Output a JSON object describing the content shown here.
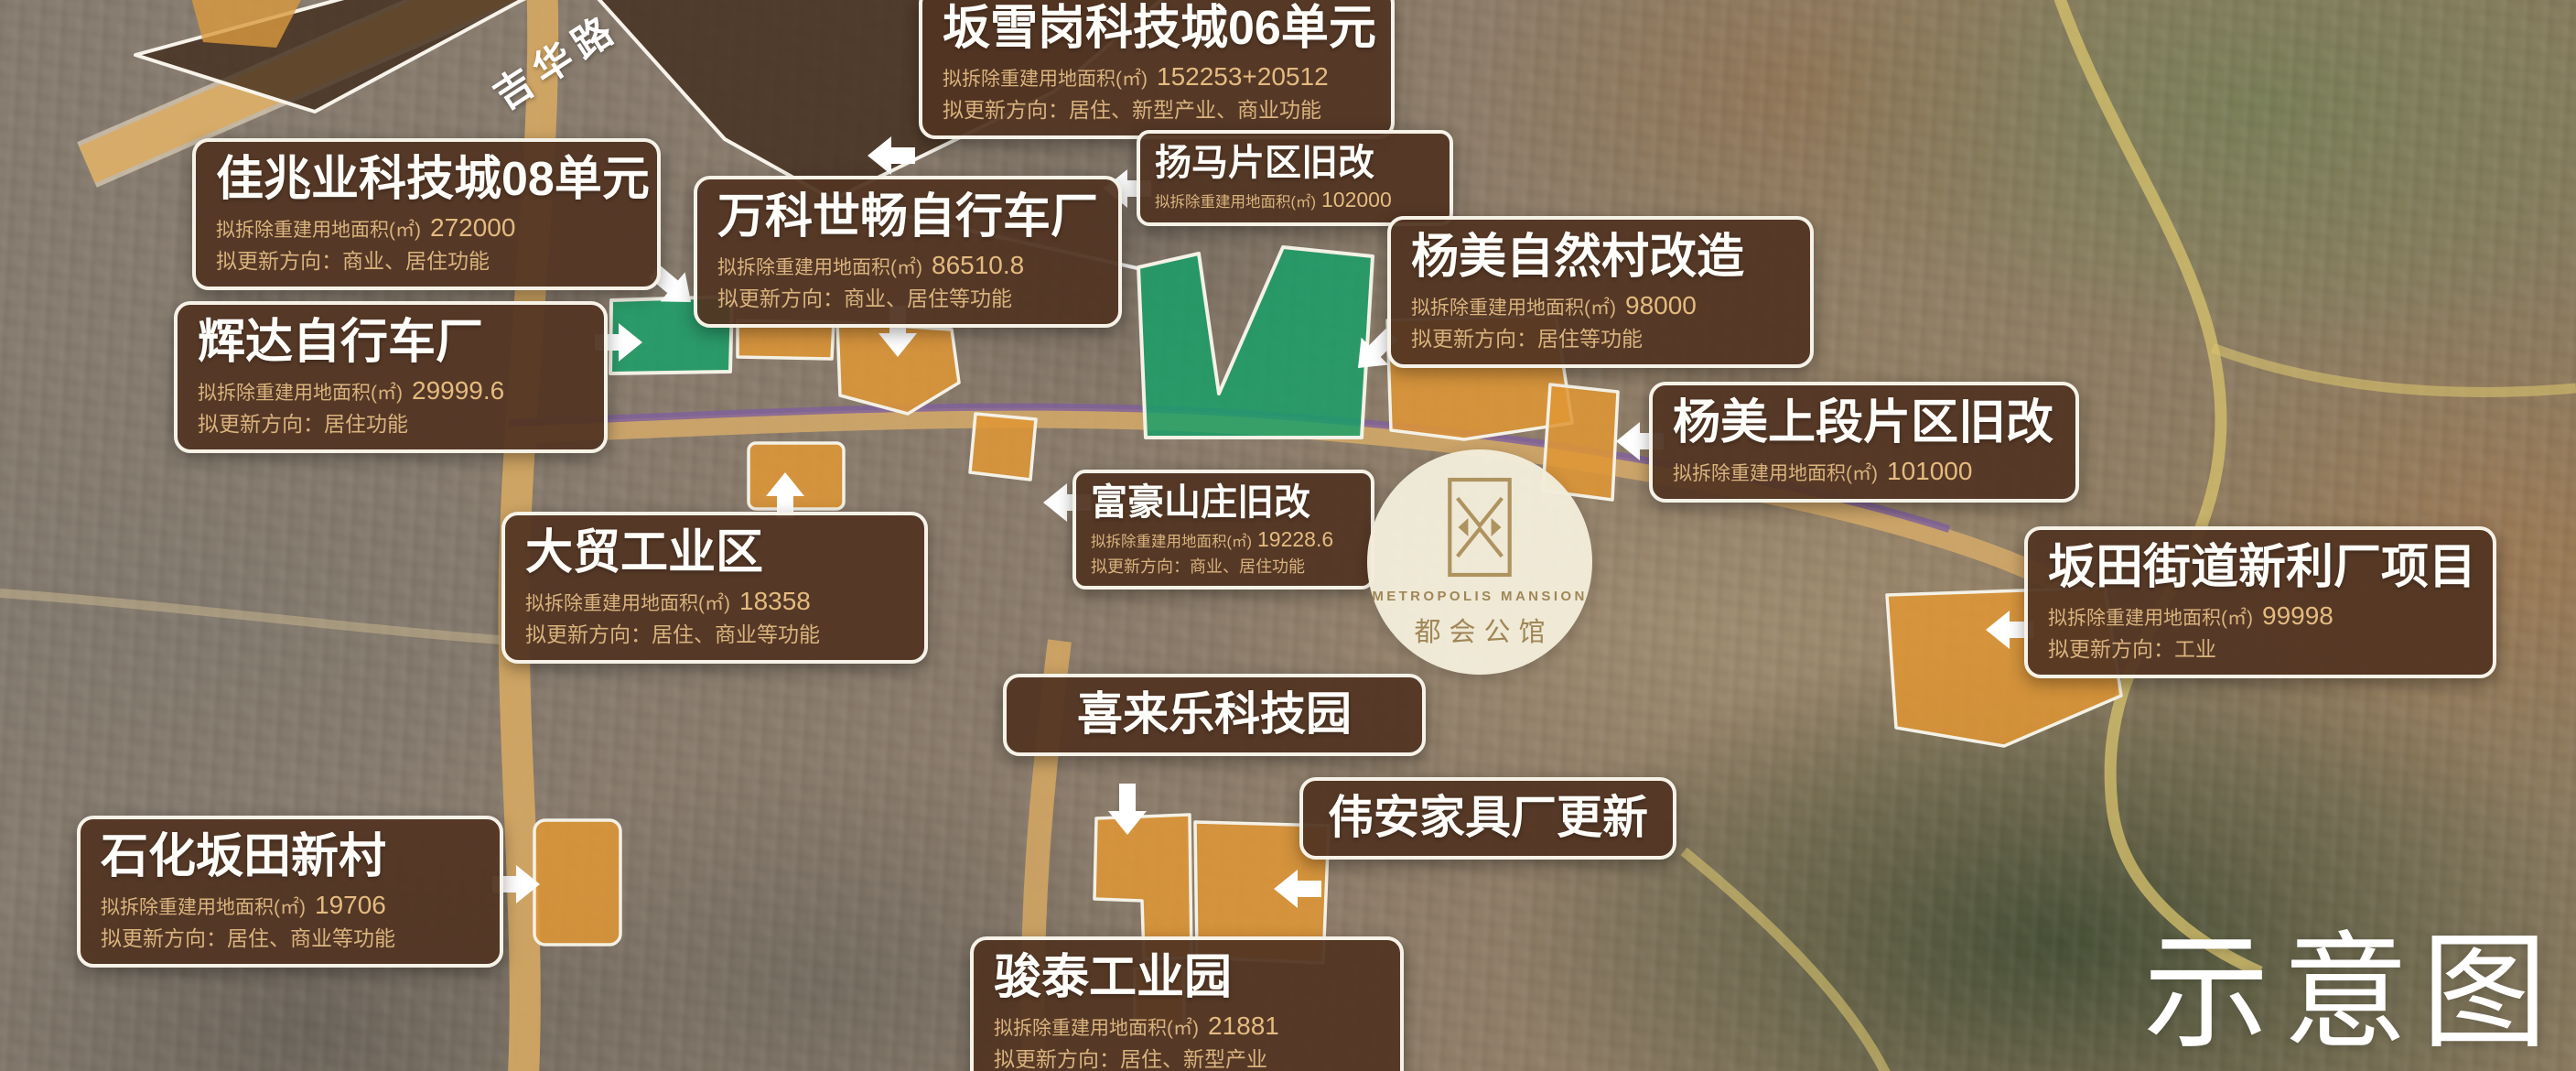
{
  "map": {
    "road_label": "吉华路",
    "watermark": "示意图",
    "logo": {
      "name_en": "METROPOLIS MANSION",
      "name_cn": "都会公馆"
    },
    "colors": {
      "callout_bg": "#54361f",
      "callout_border": "#f6f2e8",
      "callout_title": "#ffffff",
      "callout_detail": "#d9b37e",
      "zone_orange": "#e09634",
      "zone_green": "#16a068",
      "zone_dark_brown": "#402a1a",
      "road_tan": "#d8ab66",
      "metro_purple": "#7e5f9e",
      "logo_gold": "#a18757"
    }
  },
  "callouts": {
    "banxuegang": {
      "title": "坂雪岗科技城06单元",
      "area_label": "拟拆除重建用地面积(㎡)",
      "area_value": "152253+20512",
      "direction": "拟更新方向：居住、新型产业、商业功能"
    },
    "jiazhaoye": {
      "title": "佳兆业科技城08单元",
      "area_label": "拟拆除重建用地面积(㎡)",
      "area_value": "272000",
      "direction": "拟更新方向：商业、居住功能"
    },
    "wanke": {
      "title": "万科世畅自行车厂",
      "area_label": "拟拆除重建用地面积(㎡)",
      "area_value": "86510.8",
      "direction": "拟更新方向：商业、居住等功能"
    },
    "yangma": {
      "title": "扬马片区旧改",
      "area_label": "拟拆除重建用地面积(㎡)",
      "area_value": "102000"
    },
    "yangmei_village": {
      "title": "杨美自然村改造",
      "area_label": "拟拆除重建用地面积(㎡)",
      "area_value": "98000",
      "direction": "拟更新方向：居住等功能"
    },
    "huida": {
      "title": "辉达自行车厂",
      "area_label": "拟拆除重建用地面积(㎡)",
      "area_value": "29999.6",
      "direction": "拟更新方向：居住功能"
    },
    "yangmei_upper": {
      "title": "杨美上段片区旧改",
      "area_label": "拟拆除重建用地面积(㎡)",
      "area_value": "101000"
    },
    "fuhao": {
      "title": "富豪山庄旧改",
      "area_label": "拟拆除重建用地面积(㎡)",
      "area_value": "19228.6",
      "direction": "拟更新方向：商业、居住功能"
    },
    "damao": {
      "title": "大贸工业区",
      "area_label": "拟拆除重建用地面积(㎡)",
      "area_value": "18358",
      "direction": "拟更新方向：居住、商业等功能"
    },
    "xinli": {
      "title": "坂田街道新利厂项目",
      "area_label": "拟拆除重建用地面积(㎡)",
      "area_value": "99998",
      "direction": "拟更新方向：工业"
    },
    "xilaile": {
      "title": "喜来乐科技园"
    },
    "weian": {
      "title": "伟安家具厂更新"
    },
    "shihua": {
      "title": "石化坂田新村",
      "area_label": "拟拆除重建用地面积(㎡)",
      "area_value": "19706",
      "direction": "拟更新方向：居住、商业等功能"
    },
    "juntai": {
      "title": "骏泰工业园",
      "area_label": "拟拆除重建用地面积(㎡)",
      "area_value": "21881",
      "direction": "拟更新方向：居住、新型产业"
    }
  }
}
